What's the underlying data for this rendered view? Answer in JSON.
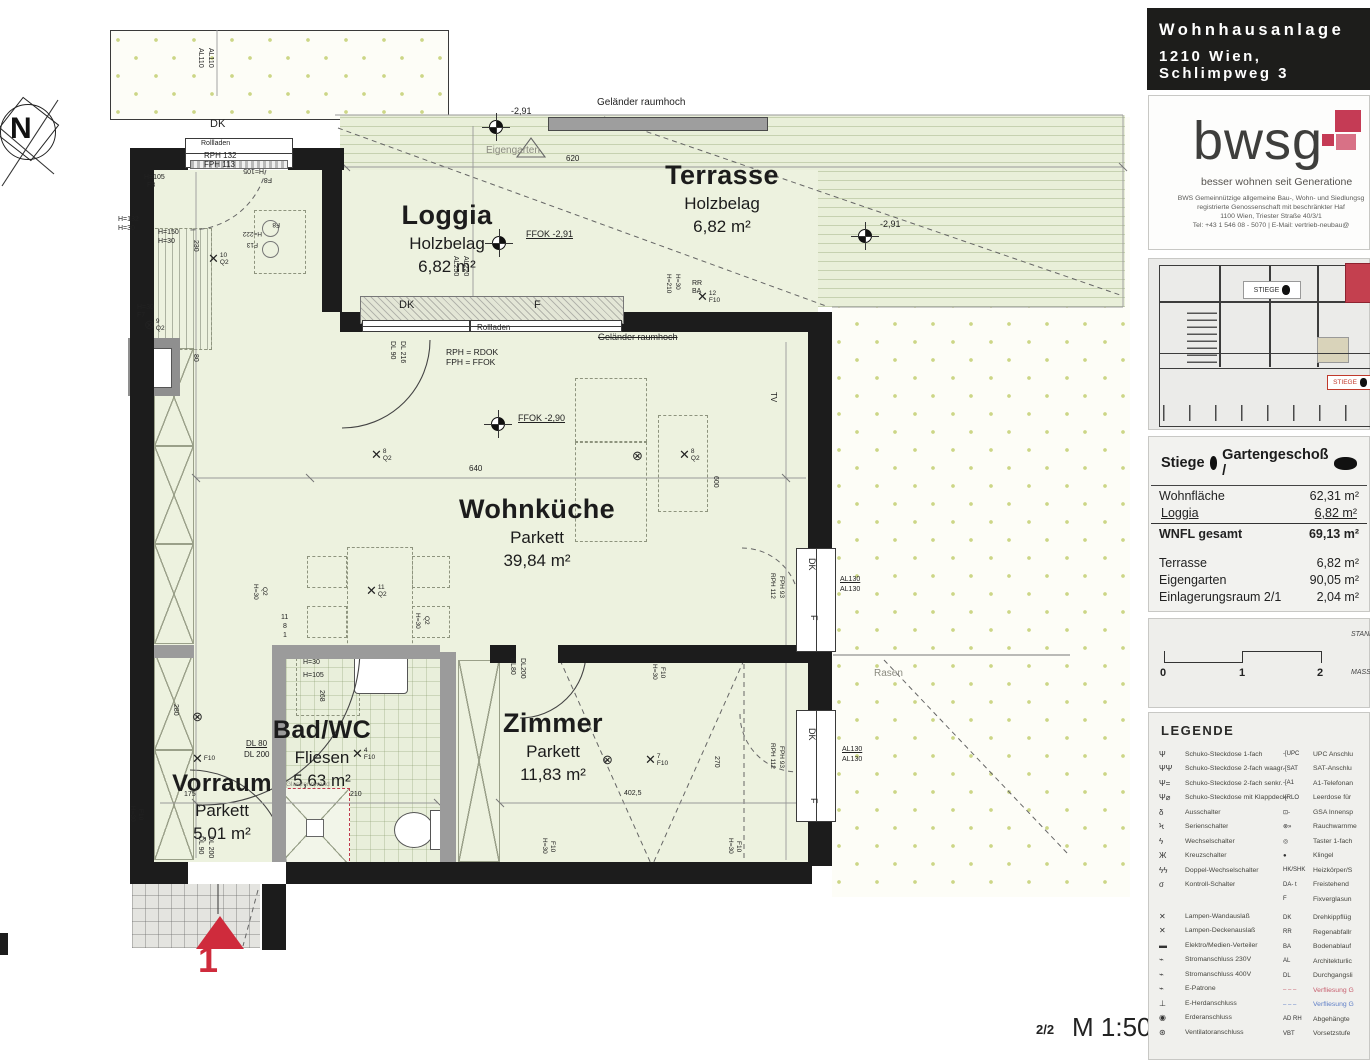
{
  "header": {
    "line1": "Wohnhausanlage",
    "line2": "1210 Wien, Schlimpweg 3"
  },
  "logo": {
    "brand": "bwsg",
    "tagline": "besser wohnen seit Generatione",
    "addr1": "BWS Gemeinnützige allgemeine Bau-, Wohn- und Siedlungsg",
    "addr2": "registrierte Genossenschaft mit beschränkter Haf",
    "addr3": "1100 Wien, Triester Straße 40/3/1",
    "addr4": "Tel: +43 1 546 08 - 5070 | E-Mail: vertrieb-neubau@"
  },
  "siteplan": {
    "l1": "STIEGE",
    "l2": "STIEGE"
  },
  "unit_table": {
    "t1": "Stiege",
    "t2": "Gartengeschoß /",
    "rows": [
      {
        "l": "Wohnfläche",
        "v": "62,31 m²"
      },
      {
        "l": "Loggia",
        "v": "6,82 m²",
        "c": "ul"
      },
      {
        "l": "WNFL gesamt",
        "v": "69,13 m²",
        "c": "b"
      },
      {
        "sp": 12
      },
      {
        "l": "Terrasse",
        "v": "6,82 m²"
      },
      {
        "l": "Eigengarten",
        "v": "90,05 m²"
      },
      {
        "l": "Einlagerungsraum 2/1",
        "v": "2,04 m²"
      }
    ]
  },
  "scalebar": {
    "n0": "0",
    "n1": "1",
    "n2": "2",
    "s1": "STAND",
    "s2": "MASS"
  },
  "legend": {
    "title": "LEGENDE",
    "left": [
      {
        "s": "Ψ",
        "l": "Schuko-Steckdose 1-fach"
      },
      {
        "s": "ΨΨ",
        "l": "Schuko-Steckdose 2-fach waagr."
      },
      {
        "s": "Ψ=",
        "l": "Schuko-Steckdose 2-fach senkr."
      },
      {
        "s": "Ψ⌀",
        "l": "Schuko-Steckdose mit Klappdeckel"
      },
      {
        "s": "δ",
        "l": "Ausschalter"
      },
      {
        "s": "Ϟ",
        "l": "Serienschalter"
      },
      {
        "s": "ϟ",
        "l": "Wechselschalter"
      },
      {
        "s": "Ж",
        "l": "Kreuzschalter"
      },
      {
        "s": "ϟϟ",
        "l": "Doppel-Wechselschalter"
      },
      {
        "s": "σ",
        "l": "Kontroll-Schalter"
      },
      {
        "sp": 17
      },
      {
        "s": "✕",
        "l": "Lampen-Wandauslaß"
      },
      {
        "s": "✕",
        "l": "Lampen-Deckenauslaß"
      },
      {
        "s": "▬",
        "l": "Elektro/Medien-Verteiler"
      },
      {
        "s": "⌁",
        "l": "Stromanschluss 230V"
      },
      {
        "s": "⌁",
        "l": "Stromanschluss 400V"
      },
      {
        "s": "⌁",
        "l": "E-Patrone"
      },
      {
        "s": "⊥",
        "l": "E-Herdanschluss"
      },
      {
        "s": "◉",
        "l": "Erderanschluss"
      },
      {
        "s": "⊛",
        "l": "Ventilatoranschluss"
      }
    ],
    "right": [
      {
        "s": "-[UPC",
        "l": "UPC Anschlu"
      },
      {
        "s": "-[SAT",
        "l": "SAT-Anschlu"
      },
      {
        "s": "-[A1",
        "l": "A1-Telefonan"
      },
      {
        "s": "-[RLO",
        "l": "Leerdose für"
      },
      {
        "s": "⊡-",
        "l": "GSA Innensp"
      },
      {
        "s": "⊗»",
        "l": "Rauchwarnme"
      },
      {
        "s": "◎",
        "l": "Taster 1-fach"
      },
      {
        "s": "●",
        "l": "Klingel"
      },
      {
        "s": "HK/SHK",
        "l": "Heizkörper/S"
      },
      {
        "s": "DA- t",
        "l": "Freistehend"
      },
      {
        "s": "F",
        "l": "Fixverglasun"
      },
      {
        "sp": 4
      },
      {
        "s": "DK",
        "l": "Drehkippflüg"
      },
      {
        "s": "RR",
        "l": "Regenabfallr"
      },
      {
        "s": "BA",
        "l": "Bodenablauf"
      },
      {
        "s": "AL",
        "l": "Architekturlic"
      },
      {
        "s": "DL",
        "l": "Durchgangsli"
      },
      {
        "s": "– – –",
        "l": "Verfliesung G",
        "c": "dr"
      },
      {
        "s": "– – –",
        "l": "Verfliesung G",
        "c": "db"
      },
      {
        "s": "AD RH",
        "l": "Abgehängte"
      },
      {
        "s": "VBT",
        "l": "Vorsetzstufe"
      }
    ]
  },
  "footer": {
    "page": "2/2",
    "scale": "M 1:50"
  },
  "plan": {
    "north": "N",
    "rooms": [
      {
        "name": "Loggia",
        "mat": "Holzbelag",
        "area": "6,82 m²",
        "x": 447,
        "y": 200,
        "ns": 27
      },
      {
        "name": "Terrasse",
        "mat": "Holzbelag",
        "area": "6,82 m²",
        "x": 722,
        "y": 160,
        "ns": 27
      },
      {
        "name": "Wohnküche",
        "mat": "Parkett",
        "area": "39,84 m²",
        "x": 537,
        "y": 494,
        "ns": 27
      },
      {
        "name": "Bad/WC",
        "mat": "Fliesen",
        "area": "5,63 m²",
        "x": 322,
        "y": 716,
        "ns": 25
      },
      {
        "name": "Zimmer",
        "mat": "Parkett",
        "area": "11,83 m²",
        "x": 553,
        "y": 708,
        "ns": 27
      },
      {
        "name": "Vorraum",
        "mat": "Parkett",
        "area": "5,01 m²",
        "x": 222,
        "y": 770,
        "ns": 24
      }
    ],
    "ann": [
      {
        "t": "DK",
        "x": 210,
        "y": 119,
        "fs": 11
      },
      {
        "t": "Rollladen",
        "x": 201,
        "y": 140,
        "fs": 7
      },
      {
        "t": "RPH 132",
        "x": 204,
        "y": 152,
        "fs": 8
      },
      {
        "t": "FPH 113",
        "x": 204,
        "y": 161,
        "fs": 8
      },
      {
        "t": "H=105",
        "x": 144,
        "y": 174,
        "fs": 7
      },
      {
        "t": "F8",
        "x": 147,
        "y": 182,
        "fs": 7
      },
      {
        "t": "H=105",
        "x": 264,
        "y": 174,
        "fs": 7,
        "r": 180
      },
      {
        "t": "F8",
        "x": 272,
        "y": 183,
        "fs": 7,
        "r": 180
      },
      {
        "t": "AL110",
        "x": 204,
        "y": 48,
        "fs": 7,
        "r": 90
      },
      {
        "t": "AL110",
        "x": 214,
        "y": 48,
        "fs": 7,
        "r": 90
      },
      {
        "t": "H=132",
        "x": 118,
        "y": 216,
        "fs": 7
      },
      {
        "t": "H=30",
        "x": 118,
        "y": 225,
        "fs": 7
      },
      {
        "t": "H=150",
        "x": 158,
        "y": 229,
        "fs": 7
      },
      {
        "t": "H=30",
        "x": 158,
        "y": 238,
        "fs": 7
      },
      {
        "t": "H=30",
        "x": 137,
        "y": 304,
        "fs": 7
      },
      {
        "t": "F7",
        "x": 137,
        "y": 312,
        "fs": 7
      },
      {
        "t": "230",
        "x": 199,
        "y": 240,
        "fs": 7,
        "r": 90
      },
      {
        "t": "80",
        "x": 199,
        "y": 354,
        "fs": 7,
        "r": 90
      },
      {
        "t": "H=222",
        "x": 262,
        "y": 236,
        "fs": 6.5,
        "r": 180
      },
      {
        "t": "F13",
        "x": 258,
        "y": 247,
        "fs": 6.5,
        "r": 180
      },
      {
        "t": "F8",
        "x": 280,
        "y": 227,
        "fs": 6.5,
        "r": 180
      },
      {
        "k": "x",
        "n": "10",
        "s": "Q2",
        "x": 208,
        "y": 252
      },
      {
        "k": "o",
        "n": "9",
        "s": "Q2",
        "x": 144,
        "y": 318
      },
      {
        "t": "Geländer raumhoch",
        "x": 597,
        "y": 98,
        "fs": 10
      },
      {
        "t": "-2,91",
        "x": 511,
        "y": 107,
        "fs": 9
      },
      {
        "t": "Eigengarten",
        "x": 486,
        "y": 146,
        "fs": 10,
        "c": "gy"
      },
      {
        "t": "620",
        "x": 566,
        "y": 155,
        "fs": 8
      },
      {
        "t": "FFOK -2,91",
        "x": 526,
        "y": 230,
        "fs": 9,
        "c": "ul"
      },
      {
        "t": "-2,91",
        "x": 880,
        "y": 220,
        "fs": 9
      },
      {
        "t": "AL250",
        "x": 459,
        "y": 256,
        "fs": 7,
        "r": 90
      },
      {
        "t": "AL220",
        "x": 469,
        "y": 256,
        "fs": 7,
        "r": 90
      },
      {
        "t": "RR",
        "x": 692,
        "y": 280,
        "fs": 7
      },
      {
        "t": "BA",
        "x": 692,
        "y": 288,
        "fs": 7
      },
      {
        "t": "H=210",
        "x": 671,
        "y": 274,
        "fs": 6.5,
        "r": 90
      },
      {
        "t": "H=30",
        "x": 680,
        "y": 274,
        "fs": 6.5,
        "r": 90
      },
      {
        "k": "x",
        "n": "12",
        "s": "F10",
        "x": 697,
        "y": 290
      },
      {
        "t": "DK",
        "x": 399,
        "y": 300,
        "fs": 11
      },
      {
        "t": "F",
        "x": 534,
        "y": 300,
        "fs": 11
      },
      {
        "t": "Rollladen",
        "x": 477,
        "y": 324,
        "fs": 8
      },
      {
        "t": "Geländer raumhoch",
        "x": 598,
        "y": 333,
        "fs": 9,
        "c": "st"
      },
      {
        "t": "RPH = RDOK",
        "x": 446,
        "y": 348,
        "fs": 8.5
      },
      {
        "t": "FPH = FFOK",
        "x": 446,
        "y": 358,
        "fs": 8.5
      },
      {
        "t": "DL 90",
        "x": 396,
        "y": 341,
        "fs": 7,
        "r": 90
      },
      {
        "t": "DL 216",
        "x": 406,
        "y": 341,
        "fs": 7,
        "r": 90
      },
      {
        "t": "FFOK -2,90",
        "x": 518,
        "y": 414,
        "fs": 9,
        "c": "ul"
      },
      {
        "k": "x",
        "n": "8",
        "s": "Q2",
        "x": 371,
        "y": 448
      },
      {
        "k": "x",
        "n": "8",
        "s": "Q2",
        "x": 679,
        "y": 448
      },
      {
        "k": "o",
        "x": 632,
        "y": 449
      },
      {
        "t": "640",
        "x": 469,
        "y": 465,
        "fs": 8
      },
      {
        "t": "600",
        "x": 719,
        "y": 476,
        "fs": 7,
        "r": 90
      },
      {
        "t": "TV",
        "x": 777,
        "y": 392,
        "fs": 8,
        "r": 90
      },
      {
        "k": "x",
        "n": "11",
        "s": "Q2",
        "x": 366,
        "y": 584
      },
      {
        "t": "H=30",
        "x": 258,
        "y": 584,
        "fs": 6.5,
        "r": 90
      },
      {
        "t": "Q2",
        "x": 267,
        "y": 587,
        "fs": 6.5,
        "r": 90
      },
      {
        "t": "11",
        "x": 281,
        "y": 614,
        "fs": 7
      },
      {
        "t": "8",
        "x": 283,
        "y": 623,
        "fs": 7
      },
      {
        "t": "1",
        "x": 283,
        "y": 632,
        "fs": 7
      },
      {
        "t": "H=30",
        "x": 420,
        "y": 613,
        "fs": 6.5,
        "r": 90
      },
      {
        "t": "Q2",
        "x": 429,
        "y": 616,
        "fs": 6.5,
        "r": 90
      },
      {
        "t": "DK",
        "x": 816,
        "y": 558,
        "fs": 9,
        "r": 90
      },
      {
        "t": "F",
        "x": 818,
        "y": 615,
        "fs": 9,
        "r": 90
      },
      {
        "t": "AL130",
        "x": 840,
        "y": 576,
        "fs": 7,
        "c": "ul"
      },
      {
        "t": "AL130",
        "x": 840,
        "y": 586,
        "fs": 7
      },
      {
        "t": "RPH 112",
        "x": 775,
        "y": 573,
        "fs": 6.5,
        "r": 90
      },
      {
        "t": "FPH 93",
        "x": 784,
        "y": 576,
        "fs": 6.5,
        "r": 90
      },
      {
        "t": "DK",
        "x": 816,
        "y": 728,
        "fs": 9,
        "r": 90
      },
      {
        "t": "F",
        "x": 818,
        "y": 798,
        "fs": 9,
        "r": 90
      },
      {
        "t": "AL130",
        "x": 842,
        "y": 746,
        "fs": 7,
        "c": "ul"
      },
      {
        "t": "AL130",
        "x": 842,
        "y": 756,
        "fs": 7
      },
      {
        "t": "RPH 112",
        "x": 775,
        "y": 743,
        "fs": 6.5,
        "r": 90
      },
      {
        "t": "FPH 93",
        "x": 784,
        "y": 746,
        "fs": 6.5,
        "r": 90
      },
      {
        "t": "Rasen",
        "x": 874,
        "y": 669,
        "fs": 10,
        "c": "gy"
      },
      {
        "t": "H=30",
        "x": 303,
        "y": 659,
        "fs": 7
      },
      {
        "t": "H=105",
        "x": 303,
        "y": 672,
        "fs": 7
      },
      {
        "t": "268",
        "x": 325,
        "y": 690,
        "fs": 7,
        "r": 90
      },
      {
        "t": "DL 80",
        "x": 246,
        "y": 740,
        "fs": 8,
        "c": "ul"
      },
      {
        "t": "DL 200",
        "x": 244,
        "y": 751,
        "fs": 8
      },
      {
        "k": "x",
        "n": "4",
        "s": "F10",
        "x": 352,
        "y": 747
      },
      {
        "t": "Glastrennwand",
        "x": 286,
        "y": 782,
        "fs": 6.5,
        "c": "gy"
      },
      {
        "t": "175",
        "x": 184,
        "y": 791,
        "fs": 7
      },
      {
        "t": "210",
        "x": 350,
        "y": 791,
        "fs": 7
      },
      {
        "k": "o",
        "x": 192,
        "y": 710
      },
      {
        "k": "x",
        "s": "F10",
        "x": 192,
        "y": 752
      },
      {
        "t": "280",
        "x": 179,
        "y": 704,
        "fs": 7,
        "r": 90
      },
      {
        "t": "DL 90",
        "x": 204,
        "y": 836,
        "fs": 7,
        "r": 90
      },
      {
        "t": "DL 200",
        "x": 214,
        "y": 836,
        "fs": 7,
        "r": 90
      },
      {
        "t": "H=30",
        "x": 135,
        "y": 806,
        "fs": 6.5,
        "r": 90
      },
      {
        "t": "F10",
        "x": 143,
        "y": 809,
        "fs": 6.5,
        "r": 90
      },
      {
        "t": "DL80",
        "x": 516,
        "y": 658,
        "fs": 7,
        "r": 90
      },
      {
        "t": "DL200",
        "x": 526,
        "y": 658,
        "fs": 7,
        "r": 90
      },
      {
        "t": "H=30",
        "x": 657,
        "y": 664,
        "fs": 6.5,
        "r": 90
      },
      {
        "t": "F10",
        "x": 665,
        "y": 667,
        "fs": 6.5,
        "r": 90
      },
      {
        "k": "o",
        "x": 602,
        "y": 753
      },
      {
        "k": "x",
        "n": "7",
        "s": "F10",
        "x": 645,
        "y": 753
      },
      {
        "t": "402,5",
        "x": 624,
        "y": 790,
        "fs": 7
      },
      {
        "t": "270",
        "x": 720,
        "y": 756,
        "fs": 7,
        "r": 90
      },
      {
        "t": "H=30",
        "x": 547,
        "y": 838,
        "fs": 6.5,
        "r": 90
      },
      {
        "t": "F10",
        "x": 555,
        "y": 841,
        "fs": 6.5,
        "r": 90
      },
      {
        "t": "H=30",
        "x": 733,
        "y": 838,
        "fs": 6.5,
        "r": 90
      },
      {
        "t": "F10",
        "x": 741,
        "y": 841,
        "fs": 6.5,
        "r": 90
      },
      {
        "t": "1",
        "x": 198,
        "y": 942,
        "fs": 36,
        "c": "red b"
      },
      {
        "k": "l",
        "x": 489,
        "y": 120
      },
      {
        "k": "l",
        "x": 858,
        "y": 229
      },
      {
        "k": "l",
        "x": 492,
        "y": 236
      },
      {
        "k": "l",
        "x": 491,
        "y": 417
      }
    ]
  }
}
